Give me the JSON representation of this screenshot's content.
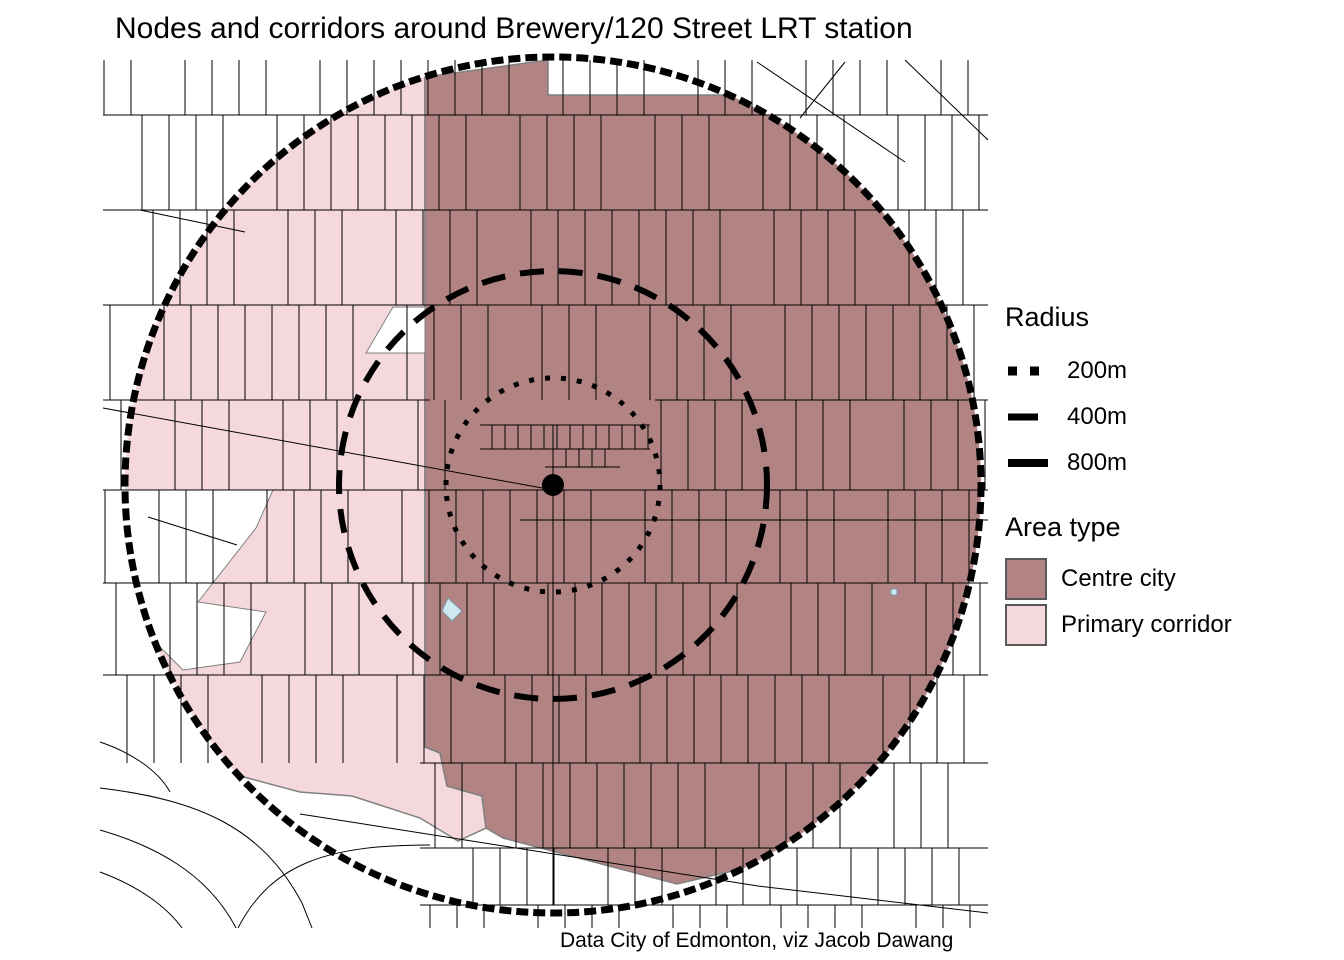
{
  "title": "Nodes and corridors around Brewery/120 Street LRT station",
  "caption": "Data City of Edmonton, viz Jacob Dawang",
  "legend": {
    "radius": {
      "title": "Radius",
      "items": [
        {
          "label": "200m",
          "style": "dotted"
        },
        {
          "label": "400m",
          "style": "dashed"
        },
        {
          "label": "800m",
          "style": "solid"
        }
      ]
    },
    "area_type": {
      "title": "Area type",
      "items": [
        {
          "label": "Centre city",
          "color": "#b18483"
        },
        {
          "label": "Primary corridor",
          "color": "#f4d8db"
        }
      ]
    }
  },
  "map": {
    "station_name": "Brewery/120 Street LRT station",
    "radii_m": [
      200,
      400,
      800
    ],
    "colors": {
      "centre_city": "#b18483",
      "primary_corridor": "#f4d8db",
      "water": "#cfe9f3",
      "street": "#000000",
      "region_border": "#808080",
      "background": "#ffffff"
    }
  }
}
